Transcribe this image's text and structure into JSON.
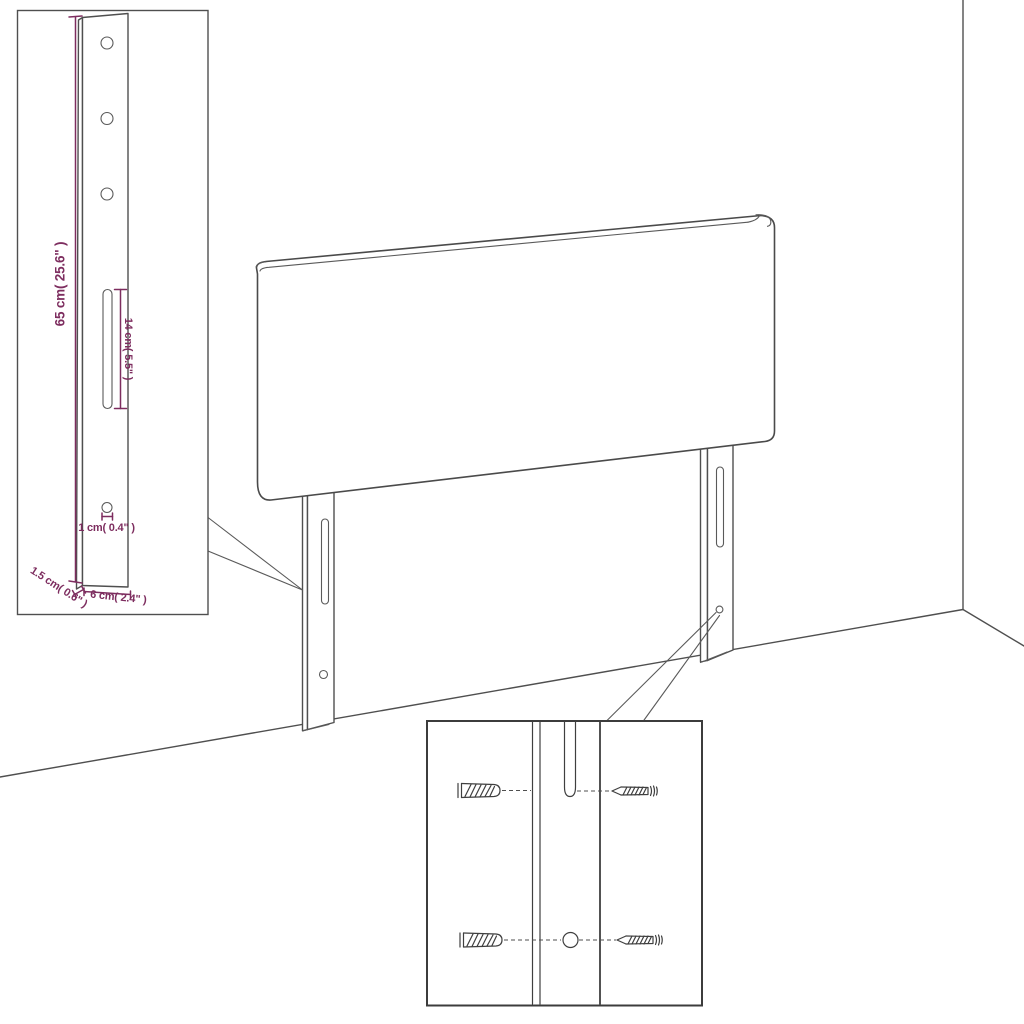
{
  "colors": {
    "outline_gray": "#4f4f4f",
    "dimension_purple": "#7d2d5f",
    "inset_border": "#3c3c3c",
    "background": "#ffffff"
  },
  "inset_left": {
    "height_label": "65 cm( 25.6\" )",
    "slot_label": "14 cm( 5.5\" )",
    "hole_label": "1 cm( 0.4\" )",
    "thickness_label": "1.5 cm( 0.6\" )",
    "width_label": "6 cm( 2.4\" )"
  },
  "icons": {
    "wall_plug": "wall-plug-icon",
    "screw": "screw-icon"
  }
}
